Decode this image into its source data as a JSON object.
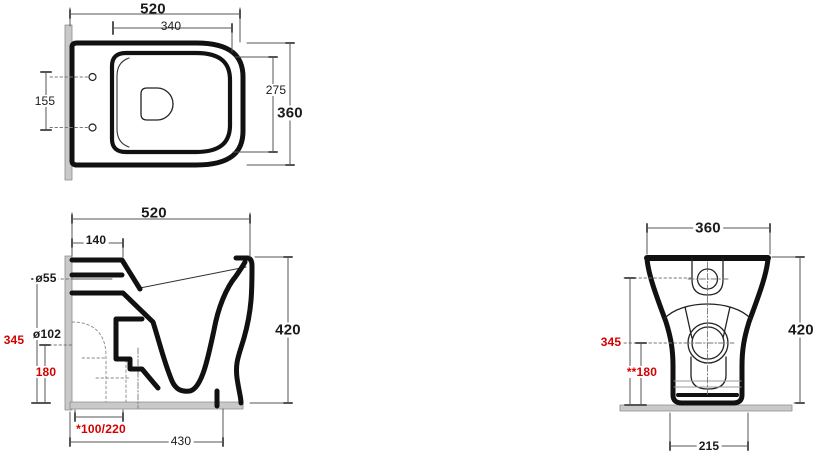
{
  "drawing_type": "toilet-technical-drawing-three-views",
  "colors": {
    "outline": "#111111",
    "dimension_lines": "#555555",
    "red_dimensions": "#d40000",
    "wall_floor_plate": "#c9c9c9",
    "background": "#ffffff"
  },
  "views": {
    "plan": {
      "title": "top view",
      "dims": {
        "overall_length": "520",
        "lid_length": "340",
        "bowl_inner_width": "275",
        "overall_width": "360",
        "fixing_hole_spacing": "155"
      }
    },
    "side": {
      "title": "side view",
      "dims": {
        "overall_length": "520",
        "seat_offset": "140",
        "inlet_diameter": "ø55",
        "outlet_diameter": "ø102",
        "inlet_height": "345",
        "outlet_height": "180",
        "outlet_distance_range": "*100/220",
        "base_depth": "430",
        "overall_height": "420"
      }
    },
    "front": {
      "title": "front view",
      "dims": {
        "overall_width": "360",
        "overall_height": "420",
        "inlet_height": "345",
        "outlet_height": "**180",
        "base_width": "215"
      }
    }
  }
}
